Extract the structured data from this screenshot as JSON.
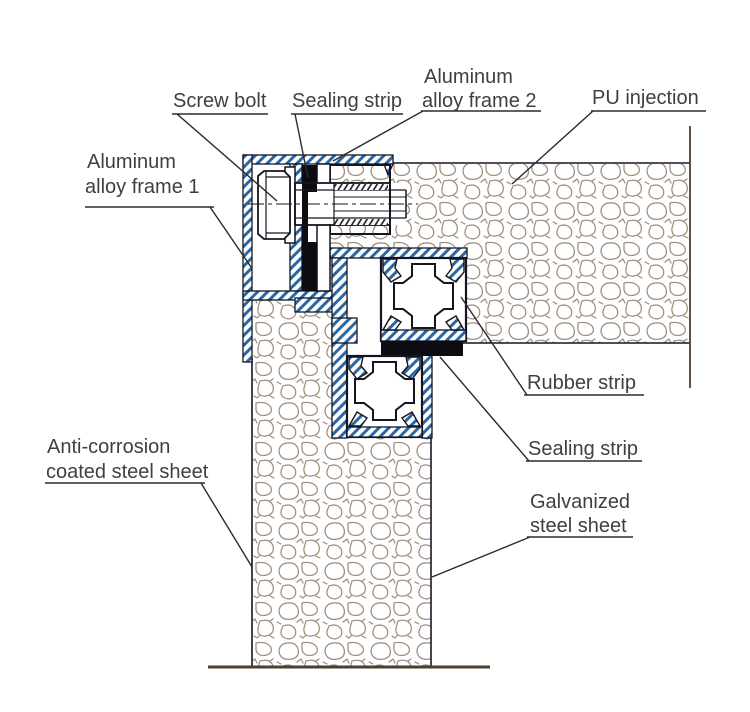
{
  "figure": {
    "title": "Insulated panel corner joint cross-section",
    "type": "technical-drawing"
  },
  "colors": {
    "hatch_blue": "#2a67a5",
    "outline": "#15151f",
    "foam_stroke": "#9c8a7a",
    "label_text": "#3f3f3f",
    "leader": "#2b2b2b",
    "ground": "#4f3d2e",
    "rubber_black": "#0c0c12"
  },
  "labels": {
    "screw_bolt": "Screw bolt",
    "sealing_strip_top": "Sealing strip",
    "aluminum_frame_2_line1": "Aluminum",
    "aluminum_frame_2_line2": "alloy frame 2",
    "pu_injection": "PU injection",
    "aluminum_frame_1_line1": "Aluminum",
    "aluminum_frame_1_line2": "alloy frame 1",
    "rubber_strip": "Rubber strip",
    "sealing_strip_bottom": "Sealing strip",
    "anti_corrosion_line1": "Anti-corrosion",
    "anti_corrosion_line2": "coated steel sheet",
    "galvanized_line1": "Galvanized",
    "galvanized_line2": "steel sheet"
  }
}
